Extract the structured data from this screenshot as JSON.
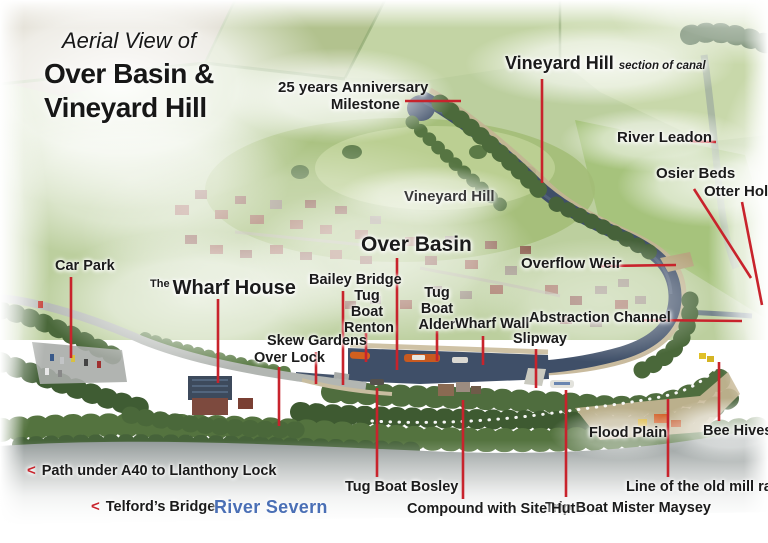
{
  "colors": {
    "leader_red": "#c8232c",
    "label_text": "#1b1b1b",
    "river_blue": "#4a6fb5",
    "canal_water": "#3f4f68",
    "field_green": "#bccf9e"
  },
  "title": {
    "prefix": "Aerial View of",
    "line1": "Over Basin &",
    "line2": "Vineyard Hill"
  },
  "annotations": {
    "milestone": {
      "line1": "25 years Anniversary",
      "line2": "Milestone"
    },
    "vineyard_hill_section": {
      "name": "Vineyard Hill",
      "suffix": "section of canal"
    },
    "river_leadon": "River Leadon",
    "osier_beds": "Osier Beds",
    "otter_holt": "Otter Holt",
    "vineyard_hill": "Vineyard Hill",
    "over_basin": "Over Basin",
    "overflow_weir": "Overflow Weir",
    "bailey_bridge": "Bailey Bridge",
    "tug_boat_renton": {
      "l1": "Tug",
      "l2": "Boat",
      "l3": "Renton"
    },
    "tug_boat_alder": {
      "l1": "Tug",
      "l2": "Boat",
      "l3": "Alder"
    },
    "wharf_wall": "Wharf Wall",
    "abstraction_channel": "Abstraction Channel",
    "slipway": "Slipway",
    "wharf_house": {
      "prefix": "The",
      "name": "Wharf House"
    },
    "car_park": "Car Park",
    "skew_gardens": "Skew Gardens",
    "over_lock": "Over Lock",
    "flood_plain": "Flood Plain",
    "bee_hives": "Bee Hives",
    "old_mill_race": "Line of the old mill race",
    "trip_boat": "Trip Boat Mister Maysey",
    "compound": "Compound with Site Hut",
    "tug_boat_bosley": "Tug Boat Bosley",
    "path_a40": {
      "arrow": "<",
      "text": "Path under A40 to Llanthony Lock"
    },
    "telfords_bridge": {
      "arrow": "<",
      "text": "Telford’s Bridge"
    },
    "river_severn": "River Severn"
  }
}
